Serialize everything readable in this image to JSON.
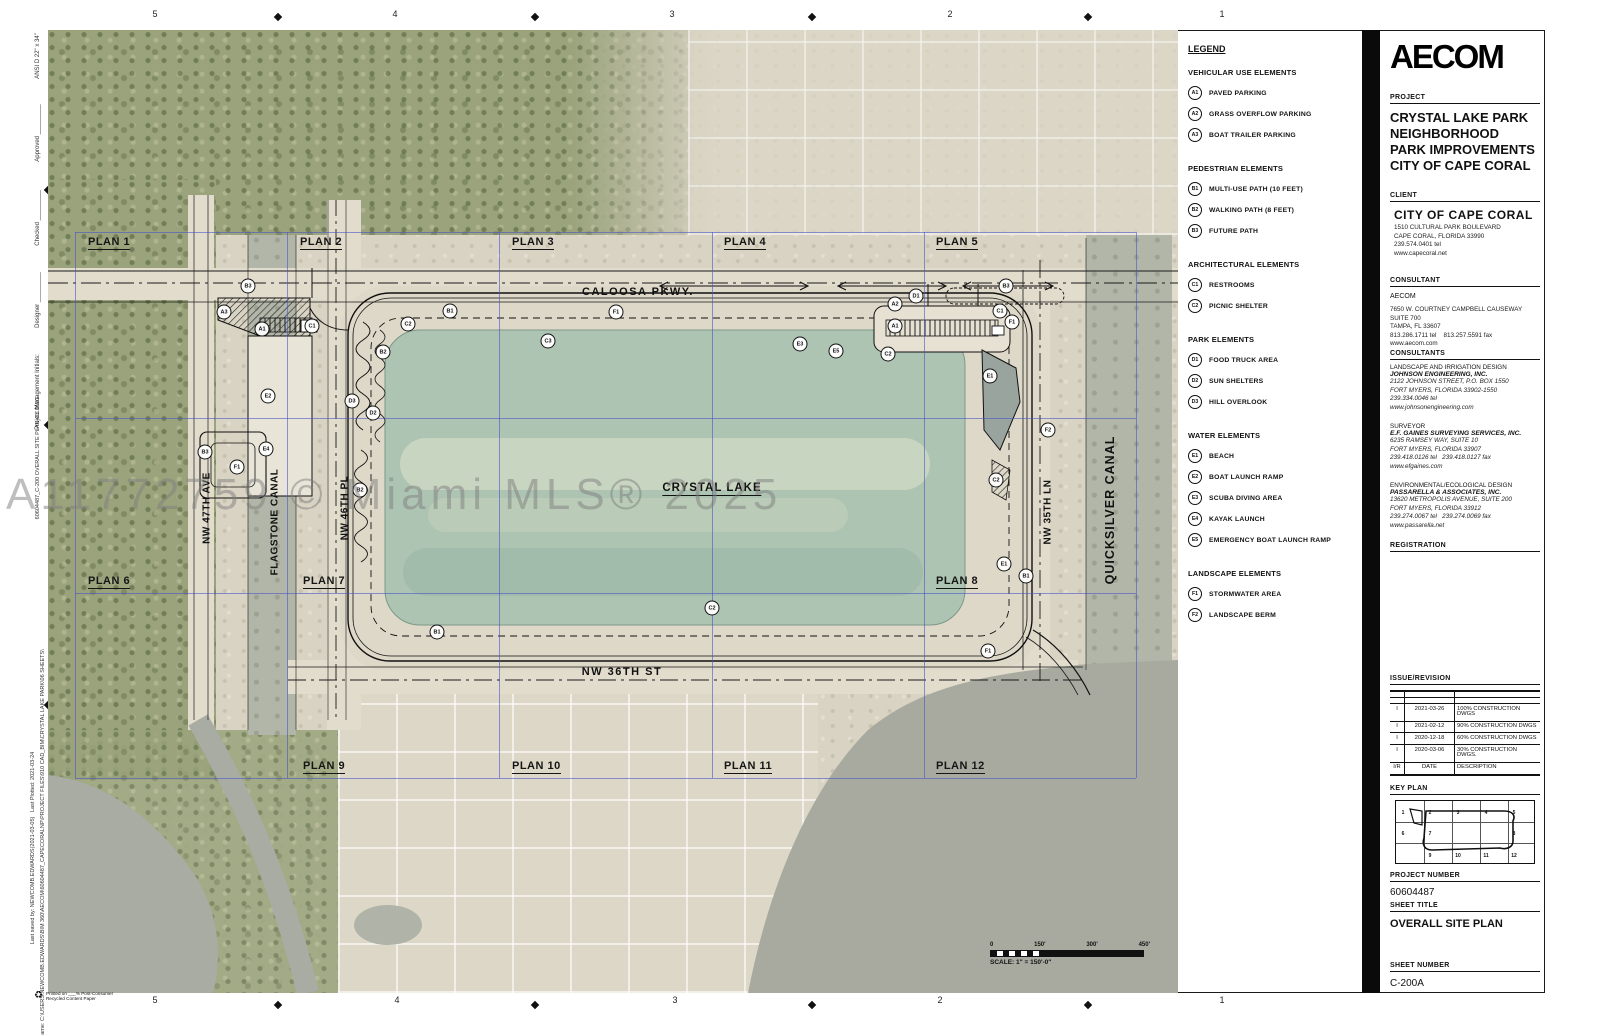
{
  "watermark": "A11772759 © Miami MLS® 2025",
  "rulers": {
    "top": [
      {
        "t": "5",
        "x": 155,
        "y": 14
      },
      {
        "t": "4",
        "x": 395,
        "y": 14
      },
      {
        "t": "3",
        "x": 672,
        "y": 14
      },
      {
        "t": "2",
        "x": 950,
        "y": 14
      },
      {
        "t": "1",
        "x": 1222,
        "y": 14
      }
    ],
    "bottom": [
      {
        "t": "5",
        "x": 155,
        "y": 1000
      },
      {
        "t": "4",
        "x": 397,
        "y": 1000
      },
      {
        "t": "3",
        "x": 675,
        "y": 1000
      },
      {
        "t": "2",
        "x": 940,
        "y": 1000
      },
      {
        "t": "1",
        "x": 1222,
        "y": 1000
      }
    ],
    "left": [
      {
        "t": "D",
        "x": 55,
        "y": 90
      },
      {
        "t": "C",
        "x": 55,
        "y": 294
      },
      {
        "t": "B",
        "x": 55,
        "y": 560
      },
      {
        "t": "A",
        "x": 55,
        "y": 855
      }
    ]
  },
  "margin_texts": [
    {
      "t": "ANSI D 22\" x 34\"",
      "x": 38,
      "y": 56,
      "s": 6
    },
    {
      "t": "Approved _________",
      "x": 38,
      "y": 133,
      "s": 6
    },
    {
      "t": "Checked _________",
      "x": 38,
      "y": 218,
      "s": 6
    },
    {
      "t": "Designer _________",
      "x": 38,
      "y": 300,
      "s": 6
    },
    {
      "t": "Project Management Initials:",
      "x": 38,
      "y": 392,
      "s": 6
    },
    {
      "t": "60604487_C-200 OVERALL SITE PLAN-CL.DWG",
      "x": 38,
      "y": 458,
      "s": 5.5
    },
    {
      "t": "Last saved by: NEWCOMB.EDWARDS(2021-03-05)   Last Plotted: 2021-03-24",
      "x": 33,
      "y": 848,
      "s": 5.5
    },
    {
      "t": "Filename: C:\\USERS\\NEWCOMB.EDWARDS\\BIM 360\\AECOM\\60604487_CAPECORALNP\\PROJECT FILES\\910 CAD_BIM\\CRYSTAL LAKE PARK\\06 SHEETS\\",
      "x": 43,
      "y": 848,
      "s": 5.5
    }
  ],
  "map": {
    "plans": [
      {
        "t": "PLAN 1",
        "x": 40,
        "y": 206
      },
      {
        "t": "PLAN 2",
        "x": 252,
        "y": 206
      },
      {
        "t": "PLAN 3",
        "x": 464,
        "y": 206
      },
      {
        "t": "PLAN 4",
        "x": 676,
        "y": 206
      },
      {
        "t": "PLAN 5",
        "x": 888,
        "y": 206
      },
      {
        "t": "PLAN 6",
        "x": 40,
        "y": 545
      },
      {
        "t": "PLAN 7",
        "x": 255,
        "y": 545
      },
      {
        "t": "PLAN 8",
        "x": 888,
        "y": 545
      },
      {
        "t": "PLAN 9",
        "x": 255,
        "y": 730
      },
      {
        "t": "PLAN 10",
        "x": 464,
        "y": 730
      },
      {
        "t": "PLAN 11",
        "x": 676,
        "y": 730
      },
      {
        "t": "PLAN 12",
        "x": 888,
        "y": 730
      }
    ],
    "streets": [
      {
        "t": "CALOOSA PKWY.",
        "x": 590,
        "y": 262,
        "cls": "hwy"
      },
      {
        "t": "NW 36TH ST",
        "x": 574,
        "y": 642,
        "cls": "hwy"
      },
      {
        "t": "NW 47TH AVE",
        "x": 159,
        "y": 478,
        "cls": "vert"
      },
      {
        "t": "FLAGSTONE CANAL",
        "x": 227,
        "y": 492,
        "cls": "vert"
      },
      {
        "t": "NW 46TH PL",
        "x": 297,
        "y": 478,
        "cls": "vert"
      },
      {
        "t": "NW 35TH LN",
        "x": 1000,
        "y": 482,
        "cls": "vert"
      },
      {
        "t": "QUICKSILVER CANAL",
        "x": 1062,
        "y": 480,
        "cls": "vert big"
      },
      {
        "t": "CRYSTAL LAKE",
        "x": 664,
        "y": 459,
        "cls": "lake"
      }
    ],
    "markers": [
      {
        "code": "B3",
        "x": 200,
        "y": 256
      },
      {
        "code": "A3",
        "x": 176,
        "y": 282
      },
      {
        "code": "A1",
        "x": 214,
        "y": 299
      },
      {
        "code": "C1",
        "x": 264,
        "y": 296
      },
      {
        "code": "E2",
        "x": 220,
        "y": 366
      },
      {
        "code": "B3",
        "x": 157,
        "y": 422
      },
      {
        "code": "E4",
        "x": 218,
        "y": 419
      },
      {
        "code": "F1",
        "x": 189,
        "y": 437
      },
      {
        "code": "D3",
        "x": 304,
        "y": 371
      },
      {
        "code": "D2",
        "x": 325,
        "y": 383
      },
      {
        "code": "B2",
        "x": 335,
        "y": 322
      },
      {
        "code": "B2",
        "x": 312,
        "y": 460
      },
      {
        "code": "C2",
        "x": 360,
        "y": 294
      },
      {
        "code": "B1",
        "x": 402,
        "y": 281
      },
      {
        "code": "C3",
        "x": 500,
        "y": 311
      },
      {
        "code": "F1",
        "x": 568,
        "y": 282
      },
      {
        "code": "E3",
        "x": 752,
        "y": 314
      },
      {
        "code": "E5",
        "x": 788,
        "y": 321
      },
      {
        "code": "C2",
        "x": 840,
        "y": 324
      },
      {
        "code": "A2",
        "x": 847,
        "y": 274
      },
      {
        "code": "D1",
        "x": 868,
        "y": 266
      },
      {
        "code": "A1",
        "x": 847,
        "y": 296
      },
      {
        "code": "B3",
        "x": 958,
        "y": 256
      },
      {
        "code": "C1",
        "x": 952,
        "y": 281
      },
      {
        "code": "F1",
        "x": 964,
        "y": 292
      },
      {
        "code": "E1",
        "x": 942,
        "y": 346
      },
      {
        "code": "F2",
        "x": 1000,
        "y": 400
      },
      {
        "code": "C2",
        "x": 948,
        "y": 450
      },
      {
        "code": "E1",
        "x": 956,
        "y": 534
      },
      {
        "code": "B1",
        "x": 978,
        "y": 546
      },
      {
        "code": "C2",
        "x": 664,
        "y": 578
      },
      {
        "code": "B1",
        "x": 389,
        "y": 602
      },
      {
        "code": "F1",
        "x": 940,
        "y": 621
      }
    ],
    "scalebar": {
      "labels": [
        {
          "t": "0"
        },
        {
          "t": "150'"
        },
        {
          "t": "300'"
        },
        {
          "t": "450'"
        }
      ],
      "note": "SCALE: 1\" = 150'-0\""
    }
  },
  "legend": {
    "title": "LEGEND",
    "vehicular": {
      "title": "VEHICULAR USE ELEMENTS",
      "items": [
        {
          "code": "A1",
          "label": "PAVED PARKING"
        },
        {
          "code": "A2",
          "label": "GRASS OVERFLOW PARKING"
        },
        {
          "code": "A3",
          "label": "BOAT TRAILER PARKING"
        }
      ]
    },
    "pedestrian": {
      "title": "PEDESTRIAN ELEMENTS",
      "items": [
        {
          "code": "B1",
          "label": "MULTI-USE PATH (10 FEET)"
        },
        {
          "code": "B2",
          "label": "WALKING PATH (8 FEET)"
        },
        {
          "code": "B3",
          "label": "FUTURE PATH"
        }
      ]
    },
    "architectural": {
      "title": "ARCHITECTURAL ELEMENTS",
      "items": [
        {
          "code": "C1",
          "label": "RESTROOMS"
        },
        {
          "code": "C2",
          "label": "PICNIC SHELTER"
        }
      ]
    },
    "park": {
      "title": "PARK ELEMENTS",
      "items": [
        {
          "code": "D1",
          "label": "FOOD TRUCK AREA"
        },
        {
          "code": "D2",
          "label": "SUN SHELTERS"
        },
        {
          "code": "D3",
          "label": "HILL OVERLOOK"
        }
      ]
    },
    "water": {
      "title": "WATER ELEMENTS",
      "items": [
        {
          "code": "E1",
          "label": "BEACH"
        },
        {
          "code": "E2",
          "label": "BOAT LAUNCH RAMP"
        },
        {
          "code": "E3",
          "label": "SCUBA DIVING AREA"
        },
        {
          "code": "E4",
          "label": "KAYAK LAUNCH"
        },
        {
          "code": "E5",
          "label": "EMERGENCY BOAT LAUNCH RAMP"
        }
      ]
    },
    "landscape": {
      "title": "LANDSCAPE ELEMENTS",
      "items": [
        {
          "code": "F1",
          "label": "STORMWATER AREA"
        },
        {
          "code": "F2",
          "label": "LANDSCAPE BERM"
        }
      ]
    }
  },
  "titleblock": {
    "logo": "AECOM",
    "project_label": "PROJECT",
    "project_title": "CRYSTAL LAKE PARK\nNEIGHBORHOOD\nPARK IMPROVEMENTS\nCITY OF CAPE CORAL",
    "client_label": "CLIENT",
    "client_name": "CITY OF CAPE CORAL",
    "client_addr": "1510 CULTURAL PARK BOULEVARD\nCAPE CORAL, FLORIDA 33990\n239.574.0401 tel\nwww.capecoral.net",
    "consultant_label": "CONSULTANT",
    "consultant_name": "AECOM",
    "consultant_addr": "7650 W. COURTNEY CAMPBELL CAUSEWAY\nSUITE 700\nTAMPA, FL 33607\n813.286.1711 tel    813.257.5591 fax\nwww.aecom.com",
    "consultants_label": "CONSULTANTS",
    "consultants": [
      {
        "role": "LANDSCAPE AND IRRIGATION DESIGN",
        "name": "JOHNSON ENGINEERING, INC.",
        "lines": "2122 JOHNSON STREET, P.O. BOX 1550\nFORT MYERS, FLORIDA 33902-1550\n239.334.0046 tel\nwww.johnsonengineering.com"
      },
      {
        "role": "SURVEYOR",
        "name": "E.F. GAINES SURVEYING SERVICES, INC.",
        "lines": "6235 RAMSEY WAY, SUITE 10\nFORT MYERS, FLORIDA 33907\n239.418.0126 tel   239.418.0127 fax\nwww.efgaines.com"
      },
      {
        "role": "ENVIRONMENTAL/ECOLOGICAL DESIGN",
        "name": "PASSARELLA & ASSOCIATES, INC.",
        "lines": "13620 METROPOLIS AVENUE, SUITE 200\nFORT MYERS, FLORIDA 33912\n239.274.0067 tel   239.274.0069 fax\nwww.passarella.net"
      }
    ],
    "registration_label": "REGISTRATION",
    "issue_label": "ISSUE/REVISION",
    "revisions": [
      {
        "m": "",
        "d": "",
        "t": ""
      },
      {
        "m": "",
        "d": "",
        "t": ""
      },
      {
        "m": "I",
        "d": "2021-03-26",
        "t": "100% CONSTRUCTION DWGS"
      },
      {
        "m": "I",
        "d": "2021-02-12",
        "t": "90% CONSTRUCTION DWGS"
      },
      {
        "m": "I",
        "d": "2020-12-18",
        "t": "60% CONSTRUCTION DWGS"
      },
      {
        "m": "I",
        "d": "2020-03-06",
        "t": "30% CONSTRUCTION DWGS."
      },
      {
        "m": "I/R",
        "d": "DATE",
        "t": "DESCRIPTION"
      }
    ],
    "keyplan_label": "KEY PLAN",
    "keyplan_numbers": [
      {
        "t": "1",
        "x": 7,
        "y": 12
      },
      {
        "t": "2",
        "x": 34,
        "y": 12
      },
      {
        "t": "3",
        "x": 62,
        "y": 12
      },
      {
        "t": "4",
        "x": 90,
        "y": 12
      },
      {
        "t": "5",
        "x": 118,
        "y": 12
      },
      {
        "t": "6",
        "x": 7,
        "y": 33
      },
      {
        "t": "7",
        "x": 34,
        "y": 33
      },
      {
        "t": "8",
        "x": 118,
        "y": 33
      },
      {
        "t": "9",
        "x": 34,
        "y": 55
      },
      {
        "t": "10",
        "x": 62,
        "y": 55
      },
      {
        "t": "11",
        "x": 90,
        "y": 55
      },
      {
        "t": "12",
        "x": 118,
        "y": 55
      }
    ],
    "project_number_label": "PROJECT NUMBER",
    "project_number": "60604487",
    "sheet_title_label": "SHEET TITLE",
    "sheet_title": "OVERALL SITE PLAN",
    "sheet_number_label": "SHEET NUMBER",
    "sheet_number": "C-200A"
  },
  "footer": {
    "symbol": "♻",
    "line1": "Printed on ___% Post-Consumer",
    "line2": "Recycled Content Paper"
  }
}
